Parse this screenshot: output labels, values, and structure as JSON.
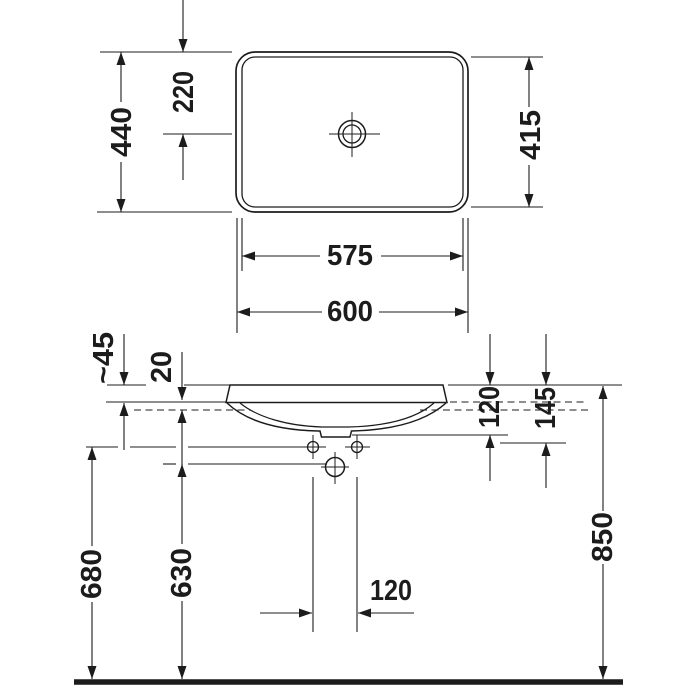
{
  "drawing": {
    "type": "technical-dimension-drawing",
    "subject": "countertop washbasin",
    "colors": {
      "line": "#1c1c1c",
      "background": "#ffffff"
    },
    "top_view": {
      "outer_width": "600",
      "inner_width": "575",
      "outer_depth": "440",
      "tap_hole_center_offset": "220",
      "inner_depth": "415"
    },
    "front_view": {
      "rim_above_counter": "~45",
      "counter_thickness": "20",
      "rim_to_underside": "120",
      "rim_to_lowest_point": "145",
      "floor_to_fixing_holes": "680",
      "floor_to_drain_center": "630",
      "fixing_hole_spacing": "120",
      "floor_to_rim": "850"
    }
  }
}
